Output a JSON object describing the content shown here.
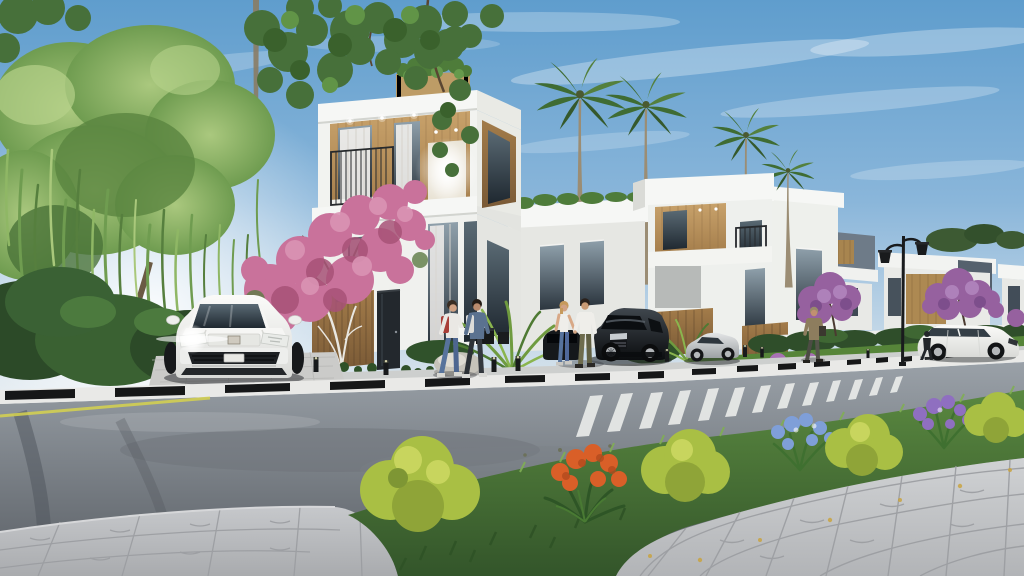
{
  "scene": {
    "title": "Modern villa complex street view - 3D architectural exterior rendering",
    "type": "photorealistic render, no visible text",
    "aspect": "1024x576"
  },
  "palette": {
    "sky_top": "#5f9dcd",
    "sky_mid": "#8ab6da",
    "sky_horizon": "#e8edf0",
    "sun_glow": "#ffffff",
    "cloud": "#ffffff",
    "wall_white": "#f6f7f5",
    "wall_shade": "#e6e7e3",
    "wall_dark": "#cfd0cc",
    "wood_light": "#c8a26b",
    "wood_dark": "#a37c4a",
    "wood_deep": "#7a5a36",
    "glass_light": "#8fa0ab",
    "glass_dark": "#2c363f",
    "curtain": "#f1efec",
    "lit_window": "#ffffff",
    "railing": "#26292c",
    "willow_light": "#aac87e",
    "willow_mid": "#6f9c50",
    "willow_dark": "#54803d",
    "leaf_dark": "#47703a",
    "bush_dark": "#2c4a28",
    "bush_mid": "#3a6132",
    "palm_green": "#3f6c33",
    "palm_light": "#5a8f44",
    "palm_trunk": "#9b8d74",
    "bougainvillea": "#c9729b",
    "bougainvillea_light": "#da94b4",
    "bougainvillea_deep": "#a75277",
    "purple_tree": "#96619f",
    "hedge": "#2f4e2a",
    "lawn": "#568539",
    "grass_top": "#5a8840",
    "grass_bottom": "#33552a",
    "bush_yellow": "#a9bf44",
    "bush_yellow_light": "#c8d55e",
    "flower_orange": "#d95f28",
    "flower_blue": "#7f9fd8",
    "flower_purple": "#8f6fc0",
    "asphalt_top": "#9aa1a8",
    "asphalt_bottom": "#5a5f65",
    "curb_white": "#e9e9e7",
    "curb_black": "#161718",
    "road_line_yellow": "#d6d24e",
    "crosswalk": "#e9ebe9",
    "walkway": "#cdcfce",
    "driveway": "#cbcbc9",
    "paver_left_light": "#c6c8cb",
    "paver_left_dark": "#a9abae",
    "paver_right_light": "#d0d2d4",
    "paver_right_dark": "#b2b4b7",
    "paver_joint": "#9b9da1",
    "car_white_hi": "#fbfbf9",
    "car_white_lo": "#d9dad7",
    "car_black_hi": "#40474e",
    "car_black_lo": "#0b0d0f",
    "car_silver_hi": "#e3e5e6",
    "car_silver_lo": "#9da1a4",
    "rim": "#b4b7ba",
    "lamp": "#191b1d",
    "skin": "#d0a183",
    "denim": "#57739c",
    "shirt_white": "#efeeea",
    "backpack_red": "#a83e38",
    "backpack_white": "#dcdcd9",
    "jacket_blue": "#5b7290",
    "olive": "#6e6c4e",
    "tan_jacket": "#8d7d5e",
    "shadow": "#2f3235"
  },
  "objects": {
    "scene": "New residential villa street, sunny day render",
    "sky": "Clear blue sky with thin clouds",
    "sun_glow": "Soft sunlight glow at left",
    "willow_tree": "Weeping willow tree",
    "street_tree": "Overhanging street tree",
    "palm_trees": "Tall palm trees",
    "main_villa": "White three-storey villa with wood accents",
    "second_villa": "Adjacent white villa with balcony",
    "rear_villa": "Rear white villa",
    "distant_villas": "Distant villa row",
    "purple_trees": "Purple blossom trees",
    "hedge": "Green hedge along plots",
    "lawn": "Front lawn strip",
    "bougainvillea": "Pink bougainvillea tree",
    "palm_bush": "Fan palm shrub",
    "rock": "Decorative white rock",
    "white_suv": "White luxury SUV parked in driveway, headlight glowing",
    "black_suv": "Black SUV parked at the curb",
    "silver_car": "Low silver coupe parked",
    "white_car": "White crossover driving on road",
    "pedestrians": "Two pedestrians walking with backpacks",
    "couple": "Couple holding hands beside black SUV",
    "man_with_bag": "Man walking with shoulder bag",
    "person_silhouette": "Pedestrian near white car",
    "street_lamp": "Black double-arm street lamp",
    "bollards": "Low black bollard path lights",
    "road": "Asphalt street",
    "crosswalk": "White zebra crosswalk",
    "curb": "Black-and-white striped curb",
    "driveway": "Paved driveway apron",
    "sidewalk_left": "Interlocking paver sidewalk, foreground left",
    "sidewalk_right": "Large paver sidewalk, foreground right",
    "grass_strip": "Green verge with shrubs",
    "flower_bed": "Orange, blue and purple flowers with yellow bushes"
  }
}
